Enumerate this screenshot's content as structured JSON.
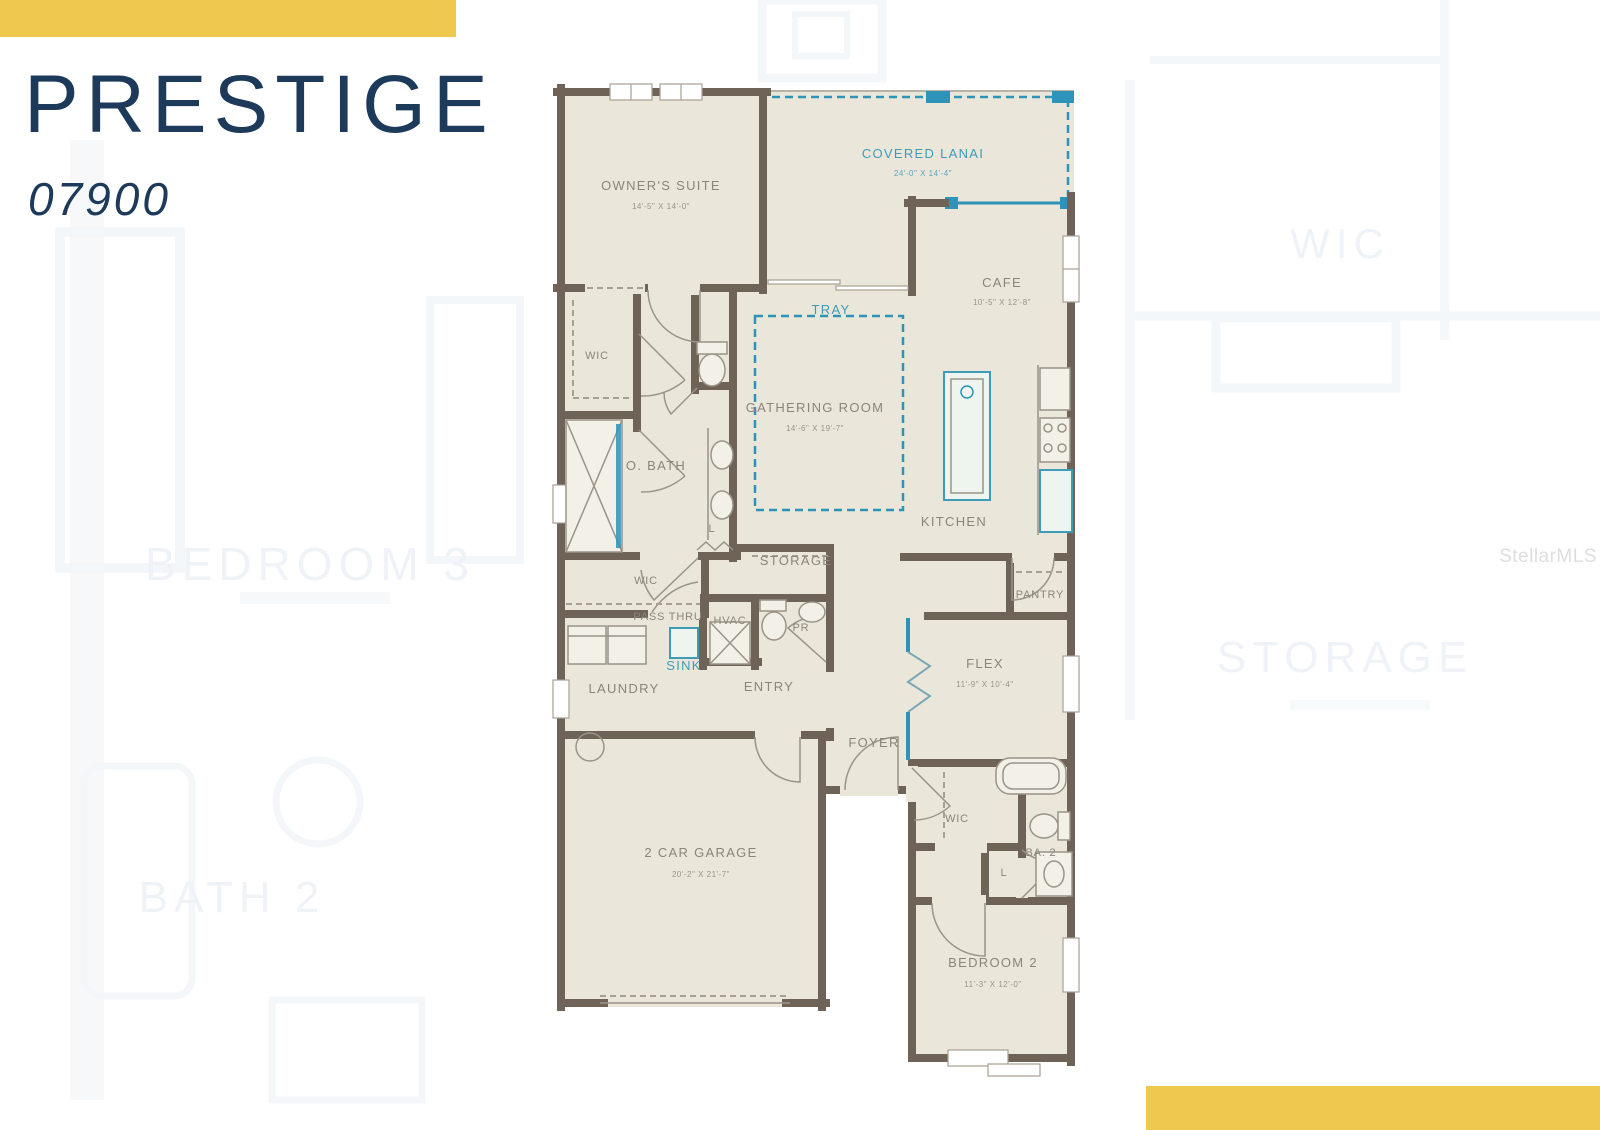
{
  "header": {
    "title": "PRESTIGE",
    "model": "07900"
  },
  "watermark": "StellarMLS",
  "colors": {
    "accent_yellow": "#efc94e",
    "title_navy": "#1d3a5a",
    "wall_brown": "#6e6356",
    "room_beige": "#eae6da",
    "plan_teal": "#2e93b8",
    "label_gray": "#8b857a"
  },
  "floorplan": {
    "rooms": {
      "owners_suite": {
        "label": "OWNER'S SUITE",
        "dims": "14'-5\" X 14'-0\""
      },
      "covered_lanai": {
        "label": "COVERED LANAI",
        "dims": "24'-0\" X 14'-4\""
      },
      "cafe": {
        "label": "CAFE",
        "dims": "10'-5\" X 12'-8\""
      },
      "tray": {
        "label": "TRAY"
      },
      "gathering_room": {
        "label": "GATHERING ROOM",
        "dims": "14'-6\" X 19'-7\""
      },
      "kitchen": {
        "label": "KITCHEN"
      },
      "pantry": {
        "label": "PANTRY"
      },
      "wic_owners": {
        "label": "WIC"
      },
      "owners_bath": {
        "label": "O. BATH"
      },
      "linen_owners_bath": {
        "label": "L"
      },
      "storage": {
        "label": "STORAGE"
      },
      "wic_hall": {
        "label": "WIC"
      },
      "pass_thru": {
        "label": "PASS THRU"
      },
      "sink": {
        "label": "SINK"
      },
      "hvac": {
        "label": "HVAC"
      },
      "powder_room": {
        "label": "PR"
      },
      "laundry": {
        "label": "LAUNDRY"
      },
      "entry": {
        "label": "ENTRY"
      },
      "flex": {
        "label": "FLEX",
        "dims": "11'-9\" X 10'-4\""
      },
      "foyer": {
        "label": "FOYER"
      },
      "wic_bedroom2": {
        "label": "WIC"
      },
      "bath2": {
        "label": "BA. 2"
      },
      "linen_hall": {
        "label": "L"
      },
      "bedroom2": {
        "label": "BEDROOM 2",
        "dims": "11'-3\" X 12'-0\""
      },
      "garage": {
        "label": "2 CAR GARAGE",
        "dims": "20'-2\" X 21'-7\""
      }
    }
  },
  "background_plan": {
    "labels": {
      "bedroom3": "BEDROOM 3",
      "wic": "WIC",
      "storage": "STORAGE",
      "bath2": "BATH 2"
    }
  }
}
